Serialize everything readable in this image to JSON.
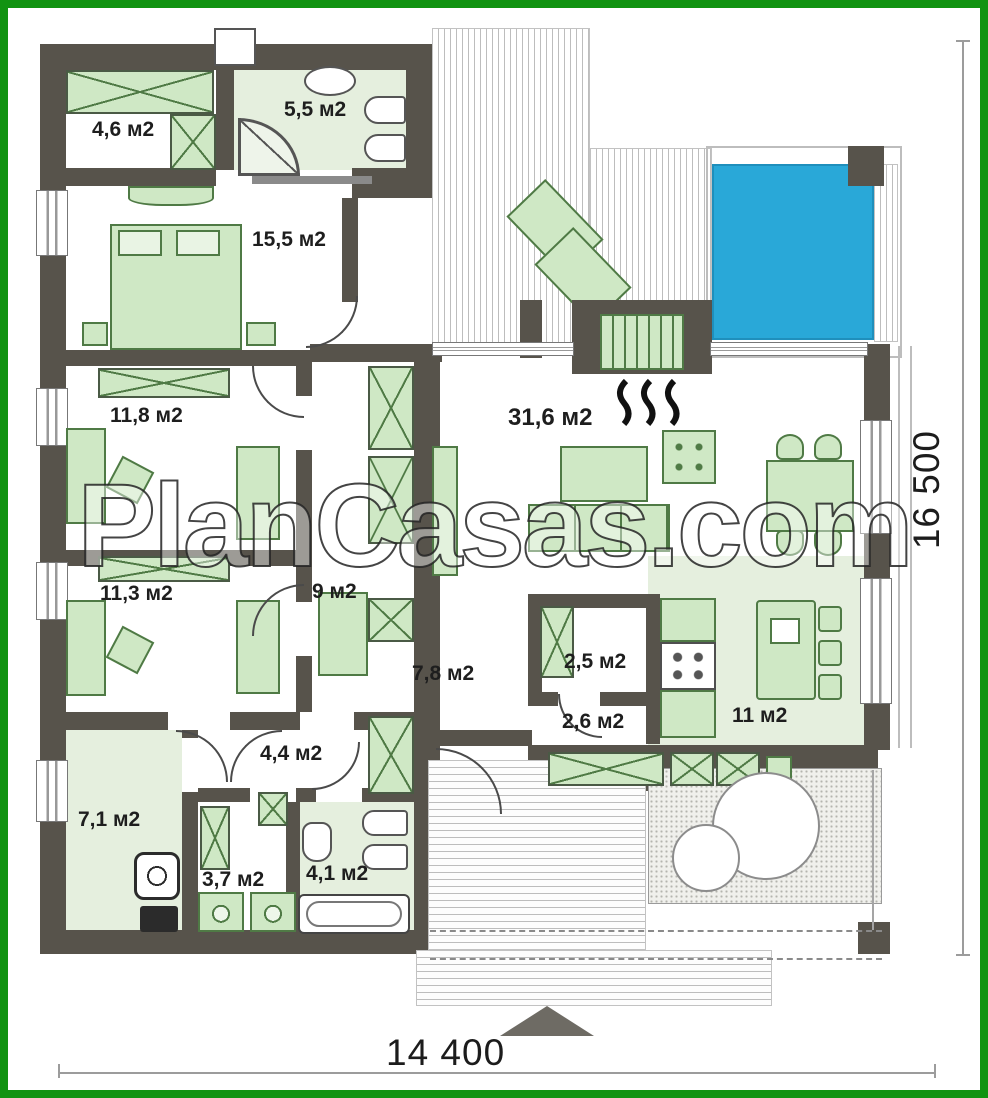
{
  "watermark": "PlanCasas.com",
  "dimensions": {
    "width": "14 400",
    "height": "16 500"
  },
  "rooms": {
    "wardrobe": "4,6 м2",
    "bath_top": "5,5 м2",
    "bedroom": "15,5 м2",
    "room118": "11,8 м2",
    "room113": "11,3 м2",
    "room9": "9 м2",
    "living": "31,6 м2",
    "hall": "7,8 м2",
    "pantry": "2,5 м2",
    "corr26": "2,6 м2",
    "kitchen": "11 м2",
    "corr44": "4,4 м2",
    "utility": "7,1 м2",
    "laundry": "3,7 м2",
    "bath_bottom": "4,1 м2"
  },
  "colors": {
    "frame_green": "#119311",
    "wall": "#57534b",
    "furniture_fill": "#cfe8c5",
    "furniture_line": "#4f7a45",
    "floor_tint": "#e5efde",
    "pool_blue": "#29a8d8"
  },
  "icons": {
    "north_arrow": "filled-triangle-up",
    "fireplace": "hearth-grate",
    "heat": "three-wavy-lines",
    "trees": "two-shrub-circles",
    "pool": "blue-water-square"
  }
}
